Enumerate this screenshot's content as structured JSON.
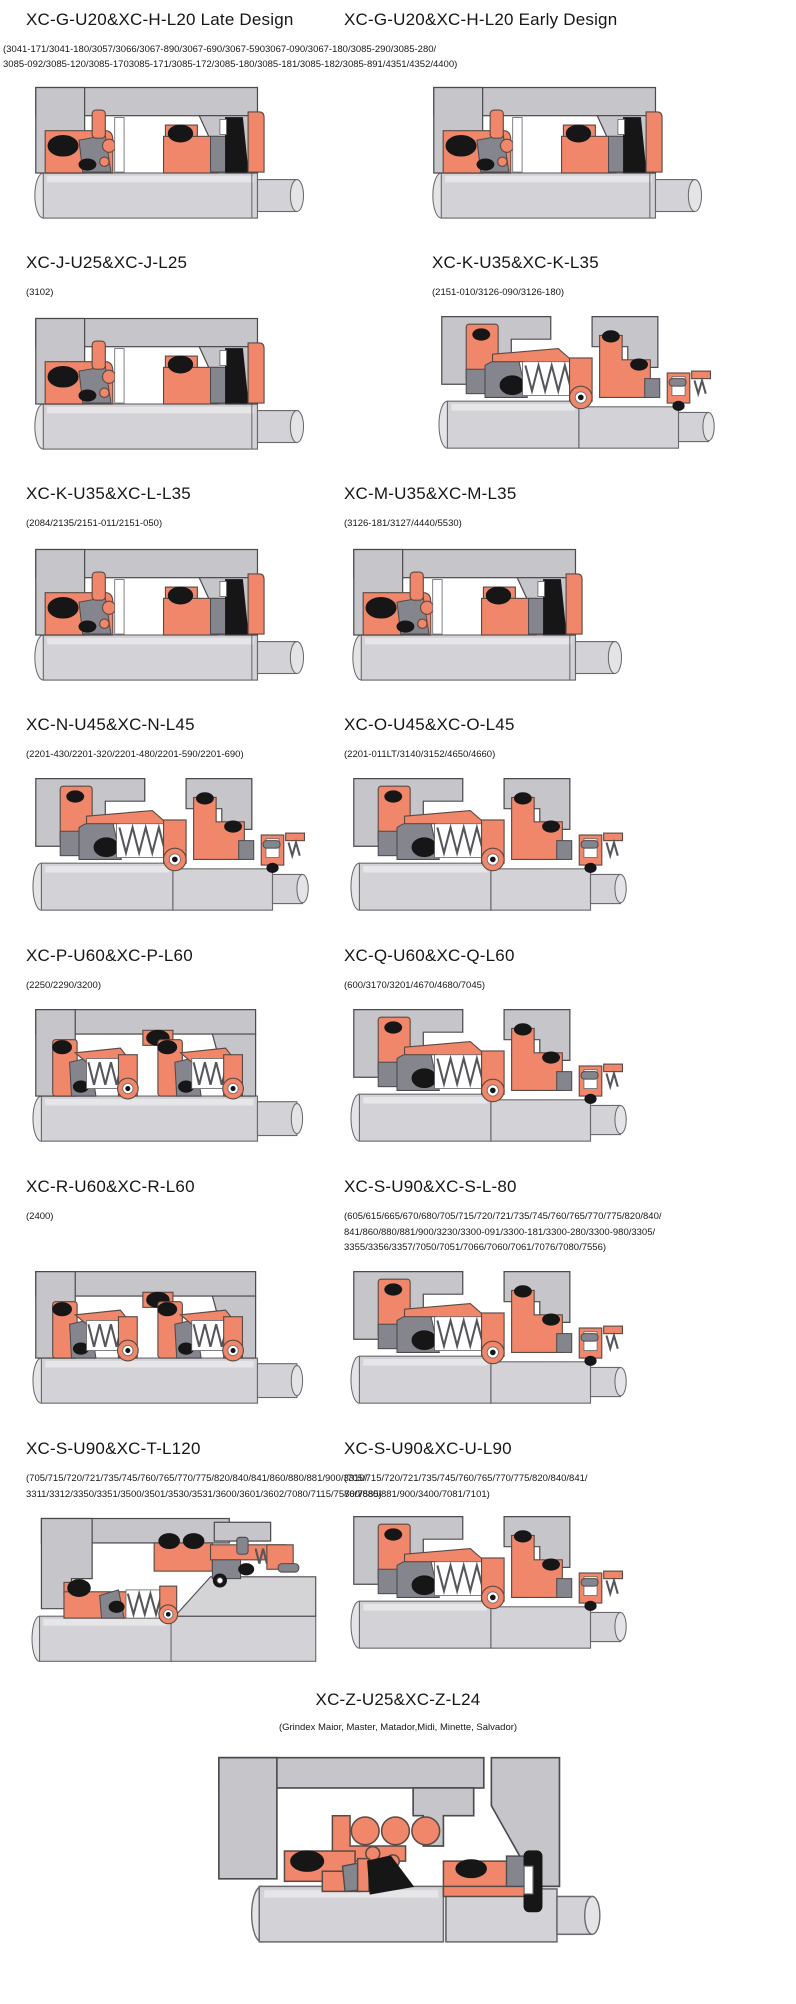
{
  "colors": {
    "background": "#FFFFFF",
    "seal_orange": "#F0876A",
    "housing_gray": "#C6C6CA",
    "dark_gray": "#85858D",
    "oring_black": "#161616",
    "shaft_gray": "#D3D3D7"
  },
  "cards": [
    {
      "title": "XC-G-U20&XC-H-L20 Late Design",
      "models": "(3041-171/3041-180/3057/3066/3067-890/3067-690/3067-5903067-090/3067-180/3085-290/3085-280/\n3085-092/3085-120/3085-1703085-171/3085-172/3085-180/3085-181/3085-182/3085-891/4351/4352/4400)"
    },
    {
      "title": "XC-G-U20&XC-H-L20 Early Design",
      "models": ""
    },
    {
      "title": "XC-J-U25&XC-J-L25",
      "models": "(3102)"
    },
    {
      "title": "XC-K-U35&XC-K-L35",
      "models": "(2151-010/3126-090/3126-180)"
    },
    {
      "title": "XC-K-U35&XC-L-L35",
      "models": "(2084/2135/2151-011/2151-050)"
    },
    {
      "title": "XC-M-U35&XC-M-L35",
      "models": "(3126-181/3127/4440/5530)"
    },
    {
      "title": "XC-N-U45&XC-N-L45",
      "models": "(2201-430/2201-320/2201-480/2201-590/2201-690)"
    },
    {
      "title": "XC-O-U45&XC-O-L45",
      "models": "(2201-011LT/3140/3152/4650/4660)"
    },
    {
      "title": "XC-P-U60&XC-P-L60",
      "models": "(2250/2290/3200)"
    },
    {
      "title": "XC-Q-U60&XC-Q-L60",
      "models": "(600/3170/3201/4670/4680/7045)"
    },
    {
      "title": "XC-R-U60&XC-R-L60",
      "models": "(2400)"
    },
    {
      "title": "XC-S-U90&XC-S-L-80",
      "models": "(605/615/665/670/680/705/715/720/721/735/745/760/765/770/775/820/840/\n841/860/880/881/900/3230/3300-091/3300-181/3300-280/3300-980/3305/\n3355/3356/3357/7050/7051/7066/7060/7061/7076/7080/7556)"
    },
    {
      "title": "XC-S-U90&XC-T-L120",
      "models": "(705/715/720/721/735/745/760/765/770/775/820/840/841/860/880/881/900/3310/\n3311/3312/3350/3351/3500/3501/3530/3531/3600/3601/3602/7080/7115/7570/7585)"
    },
    {
      "title": "XC-S-U90&XC-U-L90",
      "models": "(705/715/720/721/735/745/760/765/770/775/820/840/841/\n860/880/881/900/3400/7081/7101)"
    },
    {
      "title": "XC-Z-U25&XC-Z-L24",
      "models": "(Grindex  Maior, Master, Matador,Midi, Minette, Salvador)"
    }
  ]
}
